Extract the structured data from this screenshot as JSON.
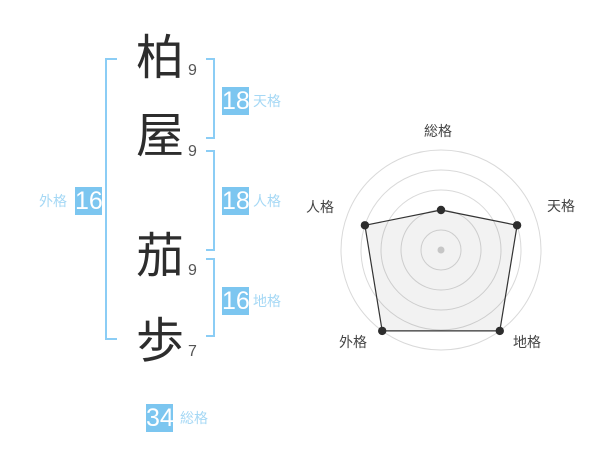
{
  "name_panel": {
    "characters": [
      {
        "char": "柏",
        "strokes": "9",
        "part": "surname"
      },
      {
        "char": "屋",
        "strokes": "9",
        "part": "surname"
      },
      {
        "char": "茄",
        "strokes": "9",
        "part": "given"
      },
      {
        "char": "歩",
        "strokes": "7",
        "part": "given"
      }
    ],
    "badges": {
      "tenkaku": {
        "label": "天格",
        "value": "18"
      },
      "jinkaku": {
        "label": "人格",
        "value": "18"
      },
      "chikaku": {
        "label": "地格",
        "value": "16"
      },
      "gaikaku": {
        "label": "外格",
        "value": "16"
      },
      "soukaku": {
        "label": "総格",
        "value": "34"
      }
    }
  },
  "colors": {
    "badge_blue": "#7cc6f0",
    "label_light_blue": "#a5d8f5",
    "bracket_blue": "#8bcdf5",
    "ring_gray": "#d9d9d9",
    "text_dark": "#444444"
  },
  "chart_data": {
    "type": "radar",
    "title": "",
    "axes": [
      "総格",
      "天格",
      "地格",
      "外格",
      "人格"
    ],
    "values": [
      2,
      4,
      5,
      5,
      4
    ],
    "max": 5,
    "rings": 5,
    "axis_order": "clockwise-from-top",
    "grid": true,
    "legend": false,
    "fill": "rgba(0,0,0,0.05)",
    "stroke": "#333333",
    "dot_color": "#2d2d2d",
    "center_dot_color": "#c6c6c6",
    "ring_color": "#d9d9d9",
    "label_color": "#444444"
  }
}
